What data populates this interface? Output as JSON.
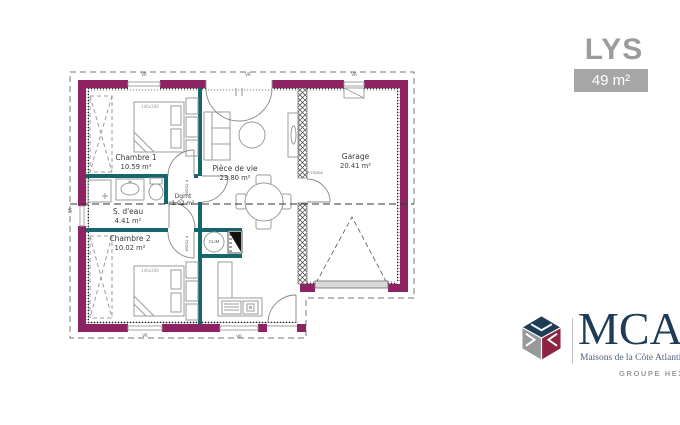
{
  "header": {
    "title": "LYS",
    "area_badge": "49 m²"
  },
  "plan": {
    "rooms": [
      {
        "name": "Chambre 1",
        "area": "10.59 m²"
      },
      {
        "name": "S. d'eau",
        "area": "4.41 m²"
      },
      {
        "name": "Chambre 2",
        "area": "10.02 m²"
      },
      {
        "name": "Dgmt",
        "area": "1.02 m²"
      },
      {
        "name": "Pièce de vie",
        "area": "23.80 m²"
      },
      {
        "name": "Garage",
        "area": "20.41 m²"
      }
    ],
    "annotations": {
      "clim": "CLIM",
      "bed_size": "140x200",
      "door_size": "P 75/204",
      "shutter": "VR"
    },
    "colors": {
      "exterior_wall": "#8e2363",
      "interior_wall": "#14666f",
      "furniture_line": "#9b9b9b",
      "label_text": "#3c3c3c"
    }
  },
  "branding": {
    "logo_text": "MCA",
    "logo_tagline": "Maisons de la Côte Atlantique",
    "group_text": "GROUPE HEXAOM",
    "colors": {
      "navy": "#1e3c55",
      "maroon": "#8e2344",
      "gray": "#97999b"
    }
  }
}
